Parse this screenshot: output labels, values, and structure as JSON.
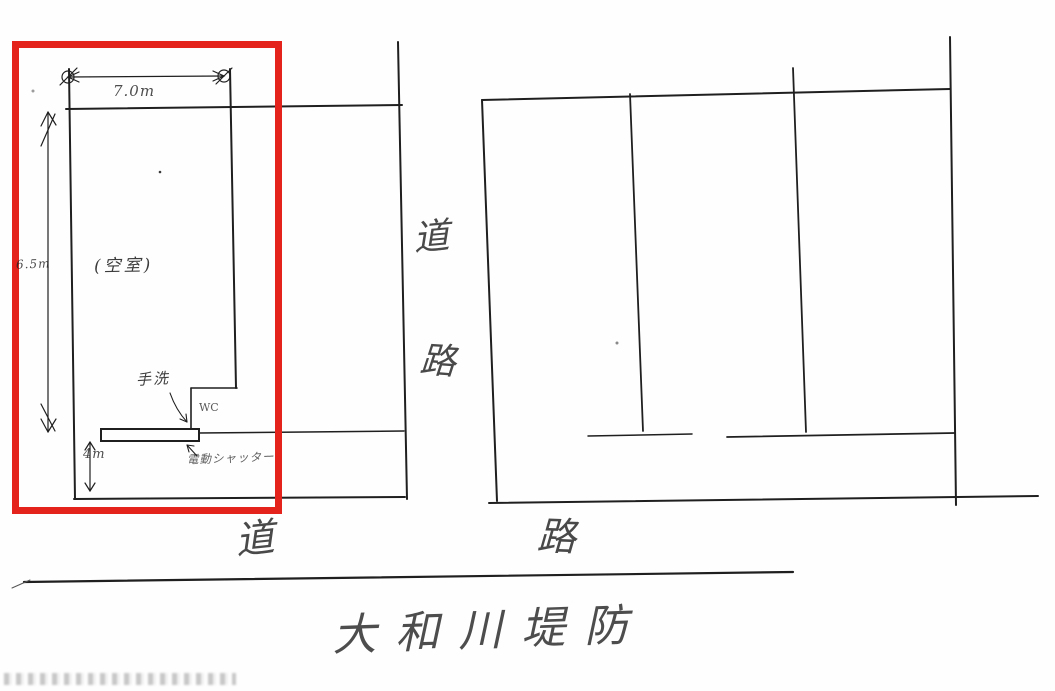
{
  "sketch": {
    "highlight": {
      "color": "#e3231c",
      "shape": "red-rectangle-annotation"
    },
    "dimensions": {
      "width_top": "7.0m",
      "height_left": "6.5m",
      "frontage": "4m"
    },
    "labels": {
      "vacant_room": "(空室)",
      "hand_wash": "手洗",
      "toilet": "WC",
      "shutter": "電動シャッター"
    },
    "roads": {
      "vertical": [
        "道",
        "路"
      ],
      "bottom": [
        "道",
        "路"
      ]
    },
    "caption": "大和川堤防",
    "ink_color": "#1f1f1f"
  }
}
